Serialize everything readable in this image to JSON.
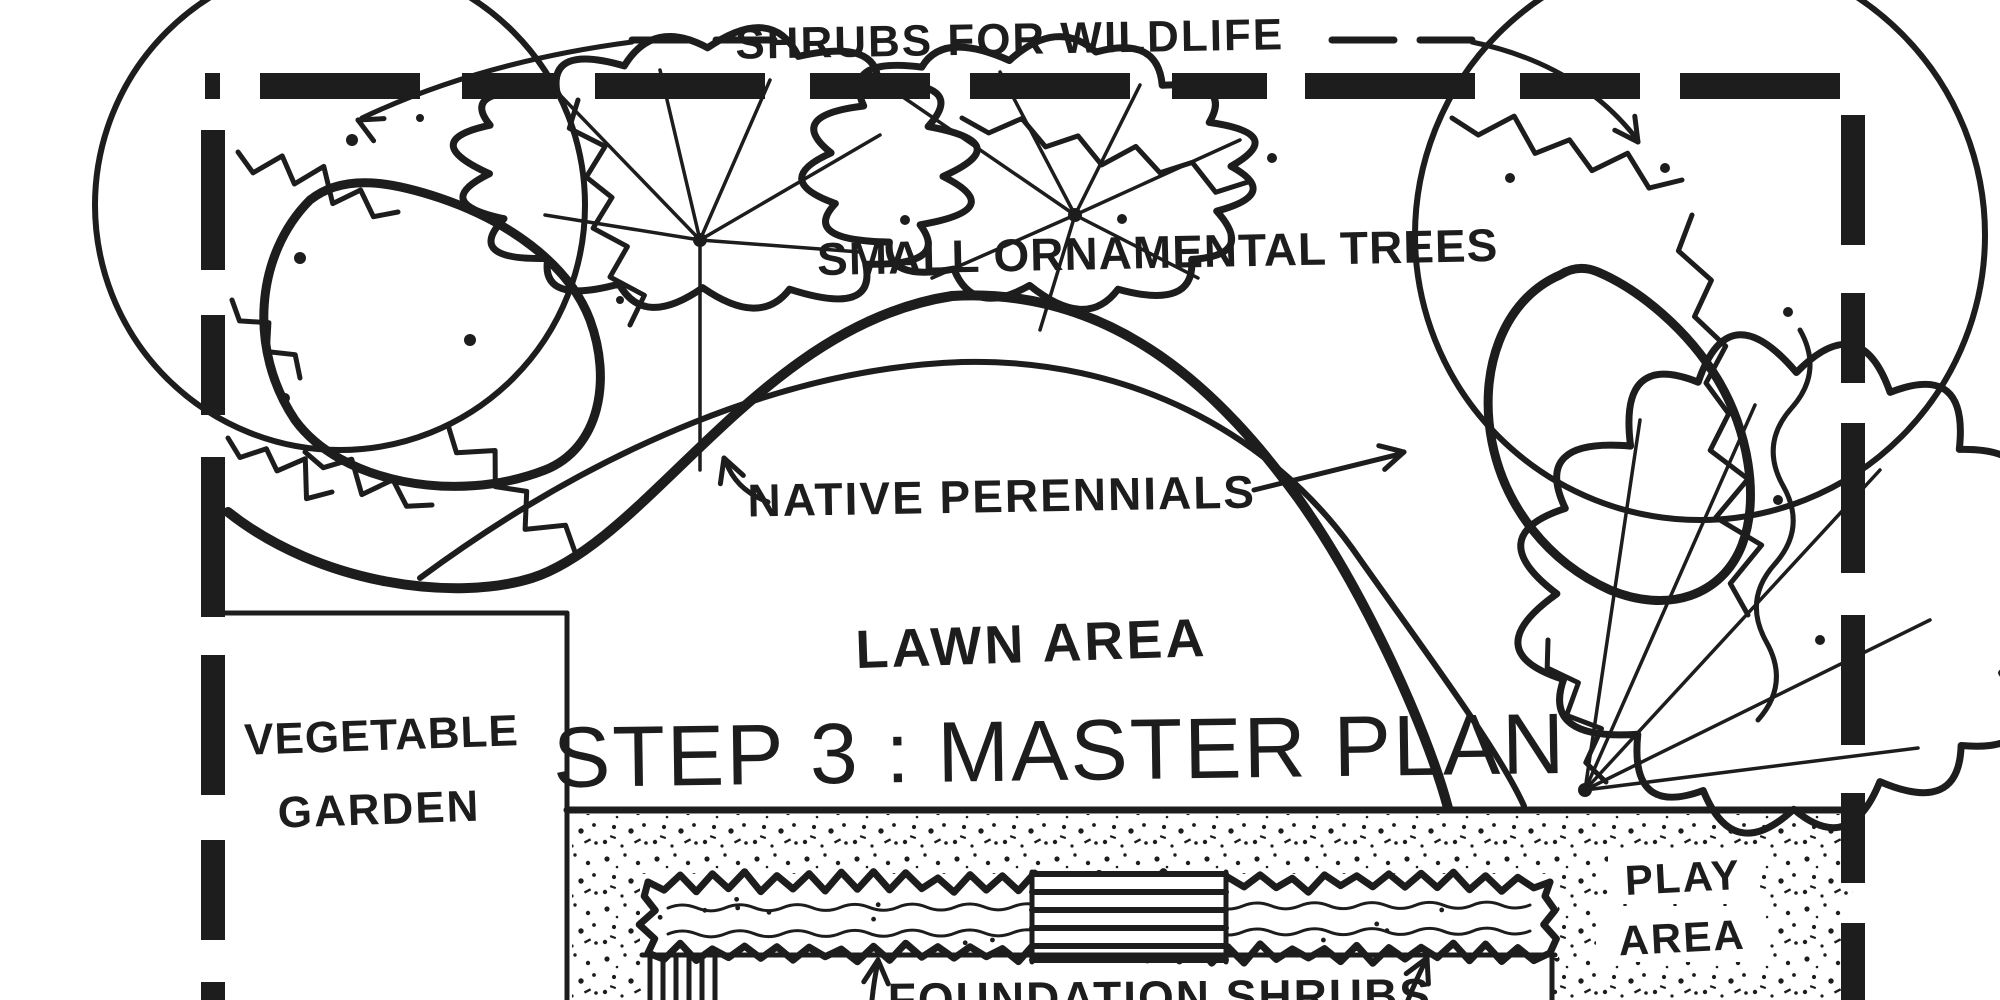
{
  "meta": {
    "drawing_title": "STEP 3 : MASTER PLAN",
    "drawing_type": "hand-drawn residential landscape design plan"
  },
  "colors": {
    "ink": "#1d1d1d",
    "paper": "#ffffff"
  },
  "labels": {
    "shrubs_for_wildlife": "SHRUBS FOR WILDLIFE",
    "small_ornamental_trees": "SMALL ORNAMENTAL TREES",
    "native_perennials": "NATIVE PERENNIALS",
    "lawn_area": "LAWN AREA",
    "step3_master_plan": "STEP 3 : MASTER PLAN",
    "vegetable_garden_line1": "VEGETABLE",
    "vegetable_garden_line2": "GARDEN",
    "play_area_line1": "PLAY",
    "play_area_line2": "AREA",
    "foundation_shrubs": "FOUNDATION SHRUBS"
  }
}
